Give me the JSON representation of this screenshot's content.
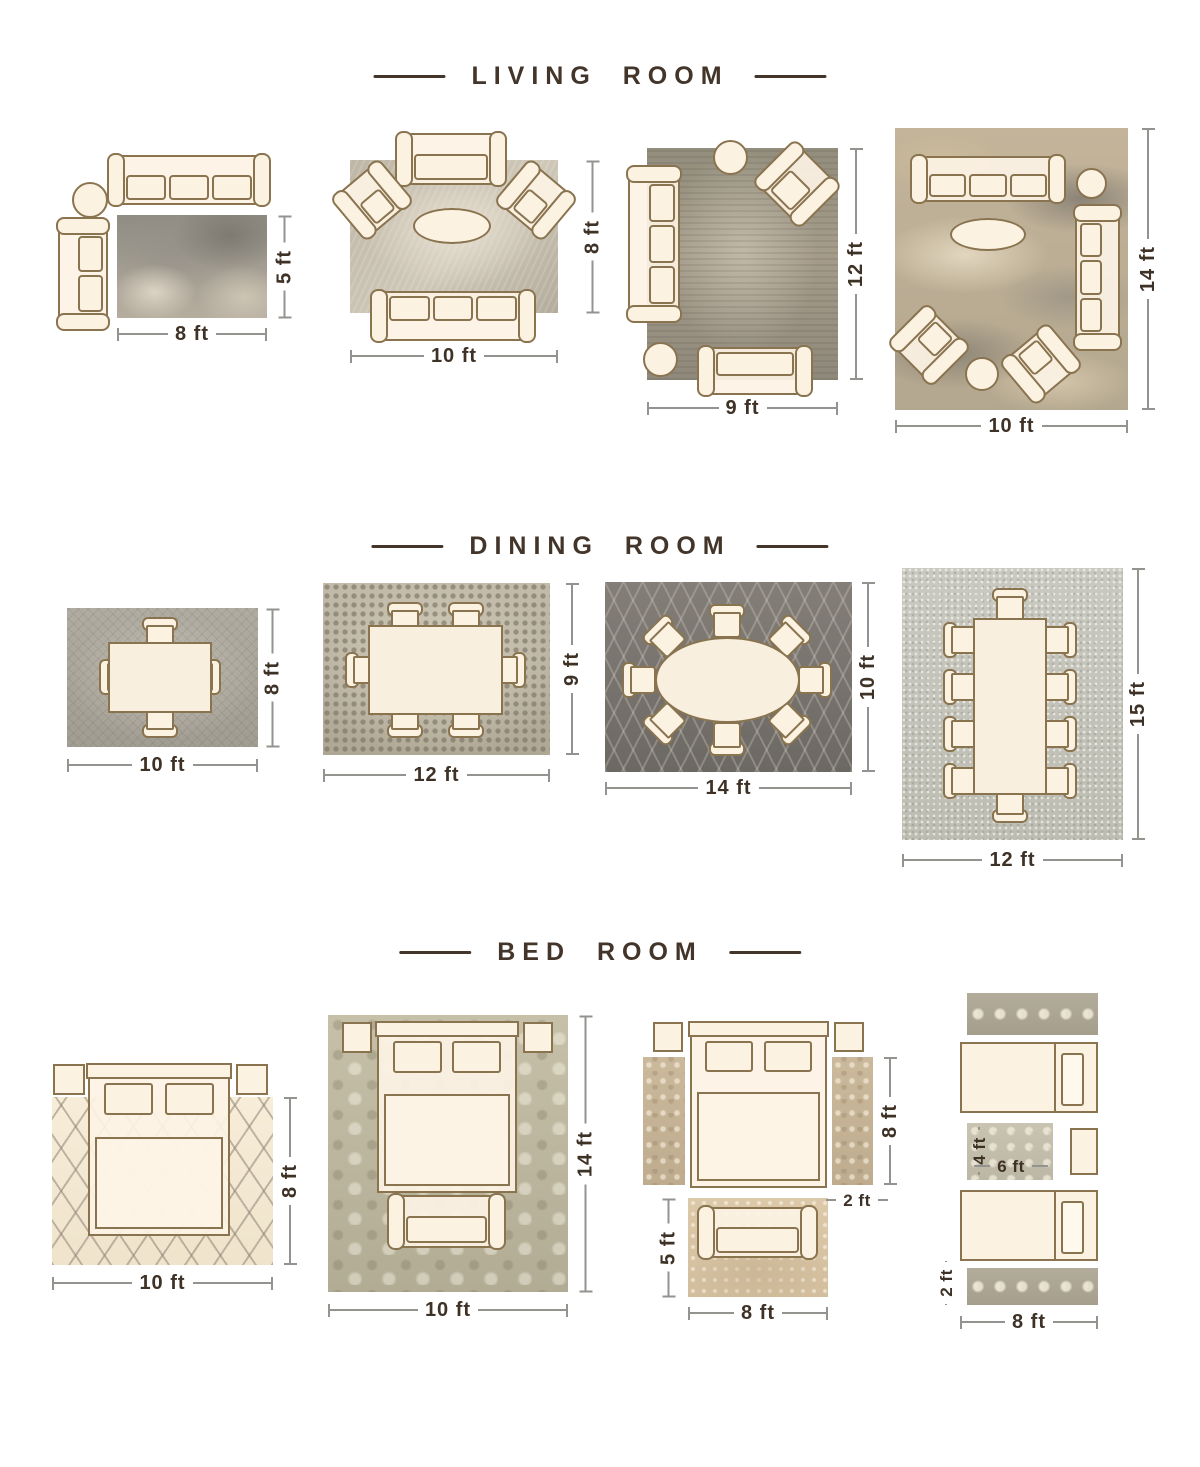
{
  "colors": {
    "background": "#ffffff",
    "title_brown": "#43352a",
    "dimension_text": "#3e3126",
    "dimension_line": "#939390",
    "furniture_outline": "#8a7450",
    "furniture_fill": "#fbf2e2"
  },
  "sections": [
    {
      "title": "LIVING ROOM",
      "layouts": [
        {
          "name": "sofa-pair-beside-rug",
          "dims": {
            "width": "8 ft",
            "height": "5 ft"
          }
        },
        {
          "name": "front-legs-on-rug",
          "dims": {
            "width": "10 ft",
            "height": "8 ft"
          }
        },
        {
          "name": "most-furniture-on-rug",
          "dims": {
            "width": "9 ft",
            "height": "12 ft"
          }
        },
        {
          "name": "all-furniture-on-rug",
          "dims": {
            "width": "10 ft",
            "height": "14 ft"
          }
        }
      ]
    },
    {
      "title": "DINING ROOM",
      "layouts": [
        {
          "name": "table-4-chairs",
          "dims": {
            "width": "10 ft",
            "height": "8 ft"
          }
        },
        {
          "name": "table-6-chairs",
          "dims": {
            "width": "12 ft",
            "height": "9 ft"
          }
        },
        {
          "name": "oval-table-8-chairs",
          "dims": {
            "width": "14 ft",
            "height": "10 ft"
          }
        },
        {
          "name": "long-table-10-chairs",
          "dims": {
            "width": "12 ft",
            "height": "15 ft"
          }
        }
      ]
    },
    {
      "title": "BED ROOM",
      "layouts": [
        {
          "name": "bed-two-thirds-on-rug",
          "dims": {
            "width": "10 ft",
            "height": "8 ft"
          }
        },
        {
          "name": "bed-fully-on-rug",
          "dims": {
            "width": "10 ft",
            "height": "14 ft"
          }
        },
        {
          "name": "bed-with-side-runners-and-foot-rug",
          "dims": {
            "bed_rug_height": "8 ft",
            "runner_width": "2 ft",
            "foot_rug_height": "5 ft",
            "foot_rug_width": "8 ft"
          }
        },
        {
          "name": "twin-beds-with-runners",
          "dims": {
            "center_rug_height": "4 ft",
            "center_rug_width": "6 ft",
            "runner_height": "2 ft",
            "runner_width": "8 ft"
          }
        }
      ]
    }
  ]
}
